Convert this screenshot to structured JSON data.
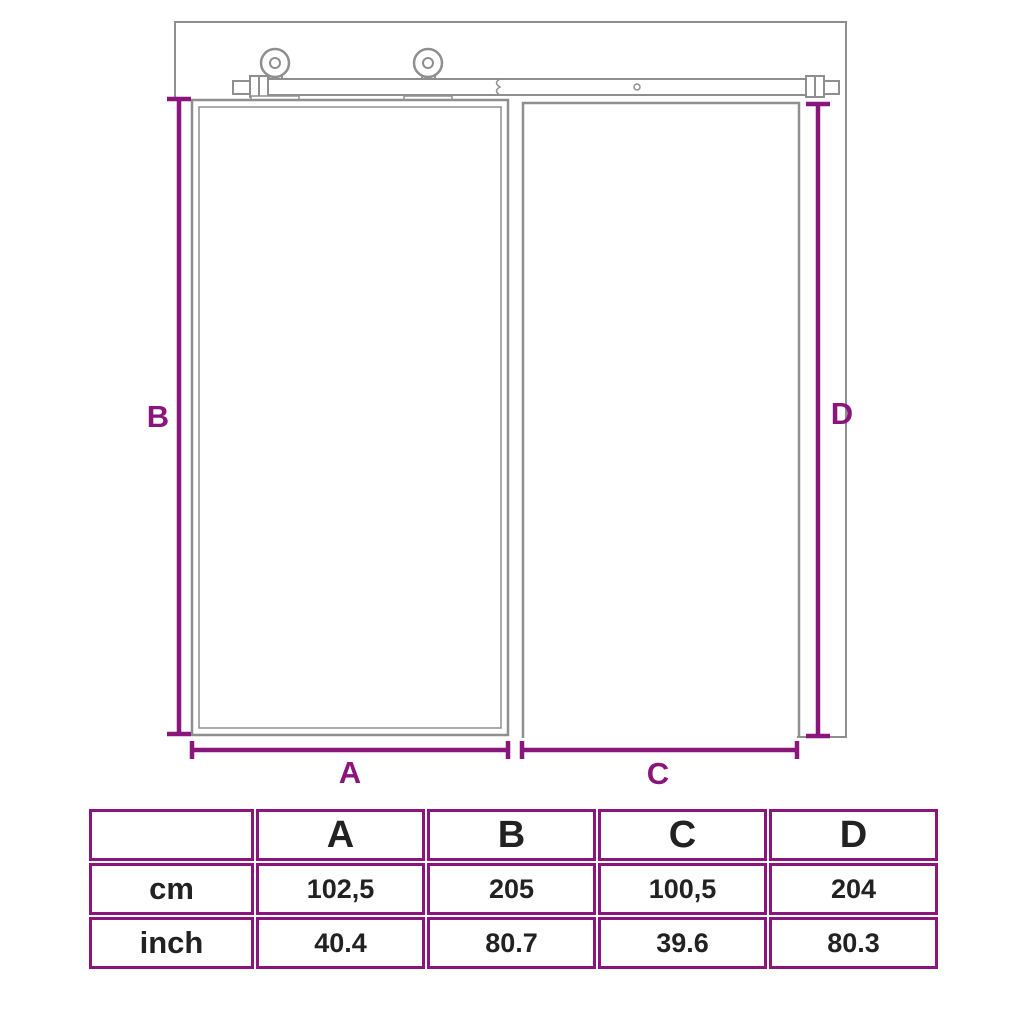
{
  "diagram": {
    "type": "sliding-door-dimension-drawing",
    "labels": {
      "a": "A",
      "b": "B",
      "c": "C",
      "d": "D"
    },
    "colors": {
      "dimension_lines": "#8A157C",
      "drawing_outlines": "#8f8f8f",
      "table_border": "#8A157C",
      "table_text": "#222222"
    }
  },
  "table": {
    "corner_label": "",
    "columns": [
      "A",
      "B",
      "C",
      "D"
    ],
    "rows": [
      {
        "label": "cm",
        "values": [
          "102,5",
          "205",
          "100,5",
          "204"
        ]
      },
      {
        "label": "inch",
        "values": [
          "40.4",
          "80.7",
          "39.6",
          "80.3"
        ]
      }
    ]
  }
}
